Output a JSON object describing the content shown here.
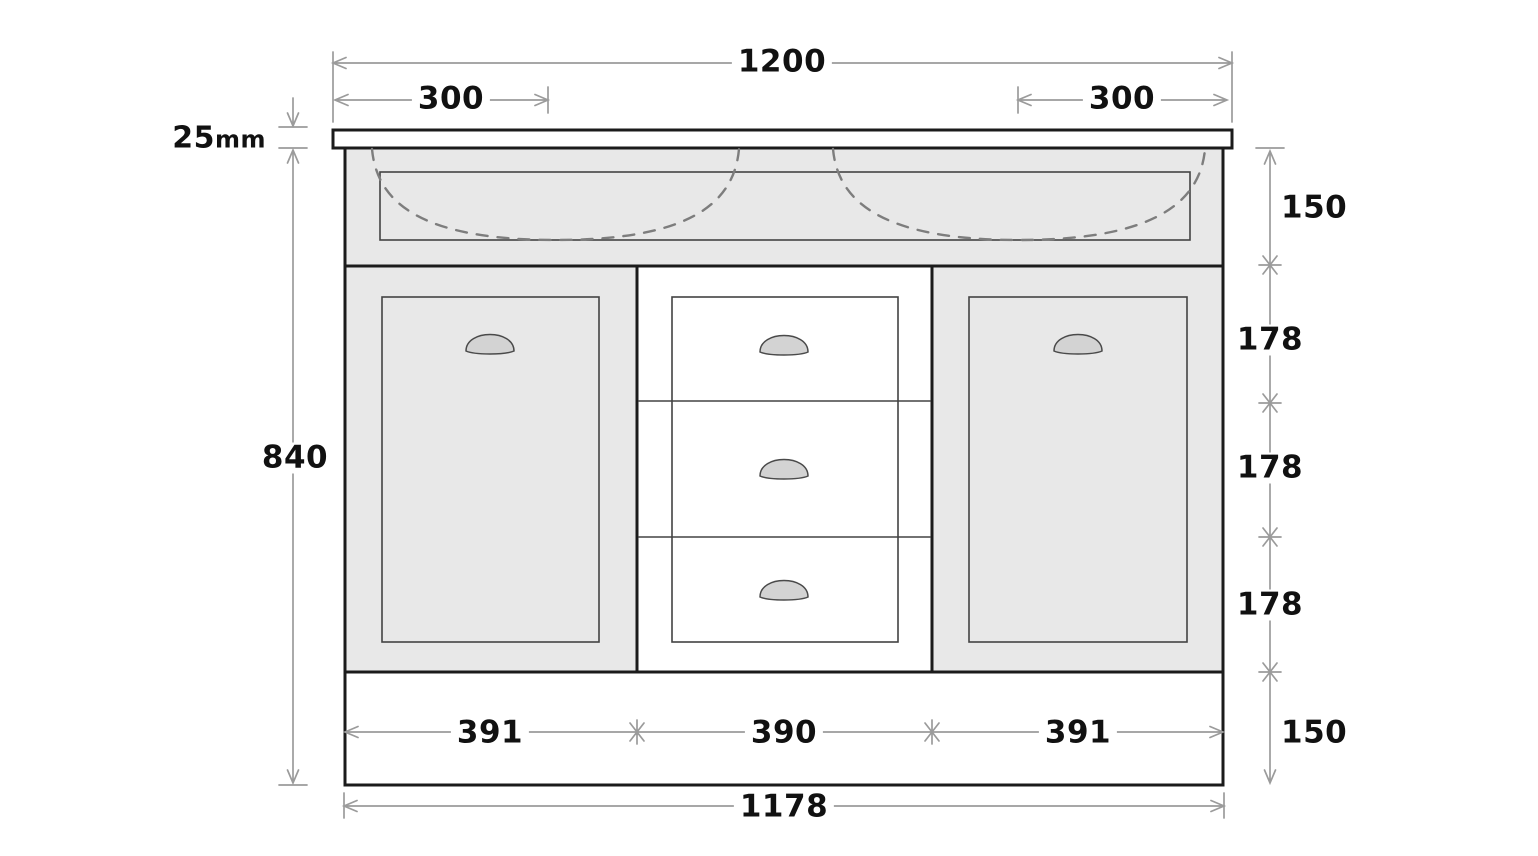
{
  "drawing": {
    "type": "vanity-cabinet-front-elevation",
    "dimensions": {
      "overall_width": "1200",
      "sink_left_offset": "300",
      "sink_right_offset": "300",
      "countertop_thickness_value": "25",
      "countertop_thickness_unit": "mm",
      "cabinet_height": "840",
      "apron_height": "150",
      "top_drawer_height": "178",
      "middle_drawer_height": "178",
      "bottom_drawer_height": "178",
      "plinth_height": "150",
      "left_door_width": "391",
      "drawer_bank_width": "390",
      "right_door_width": "391",
      "carcass_width": "1178"
    },
    "colors": {
      "cabinet_fill": "#e8e8e8",
      "handle_fill": "#d3d3d3",
      "handle_line": "#4a4a4a",
      "panel_line": "#434343",
      "outline": "#1b1b1b",
      "dim_line": "#9b9b9b",
      "sink_dash": "#7d7d7d",
      "text": "#111111",
      "background": "#ffffff"
    }
  }
}
